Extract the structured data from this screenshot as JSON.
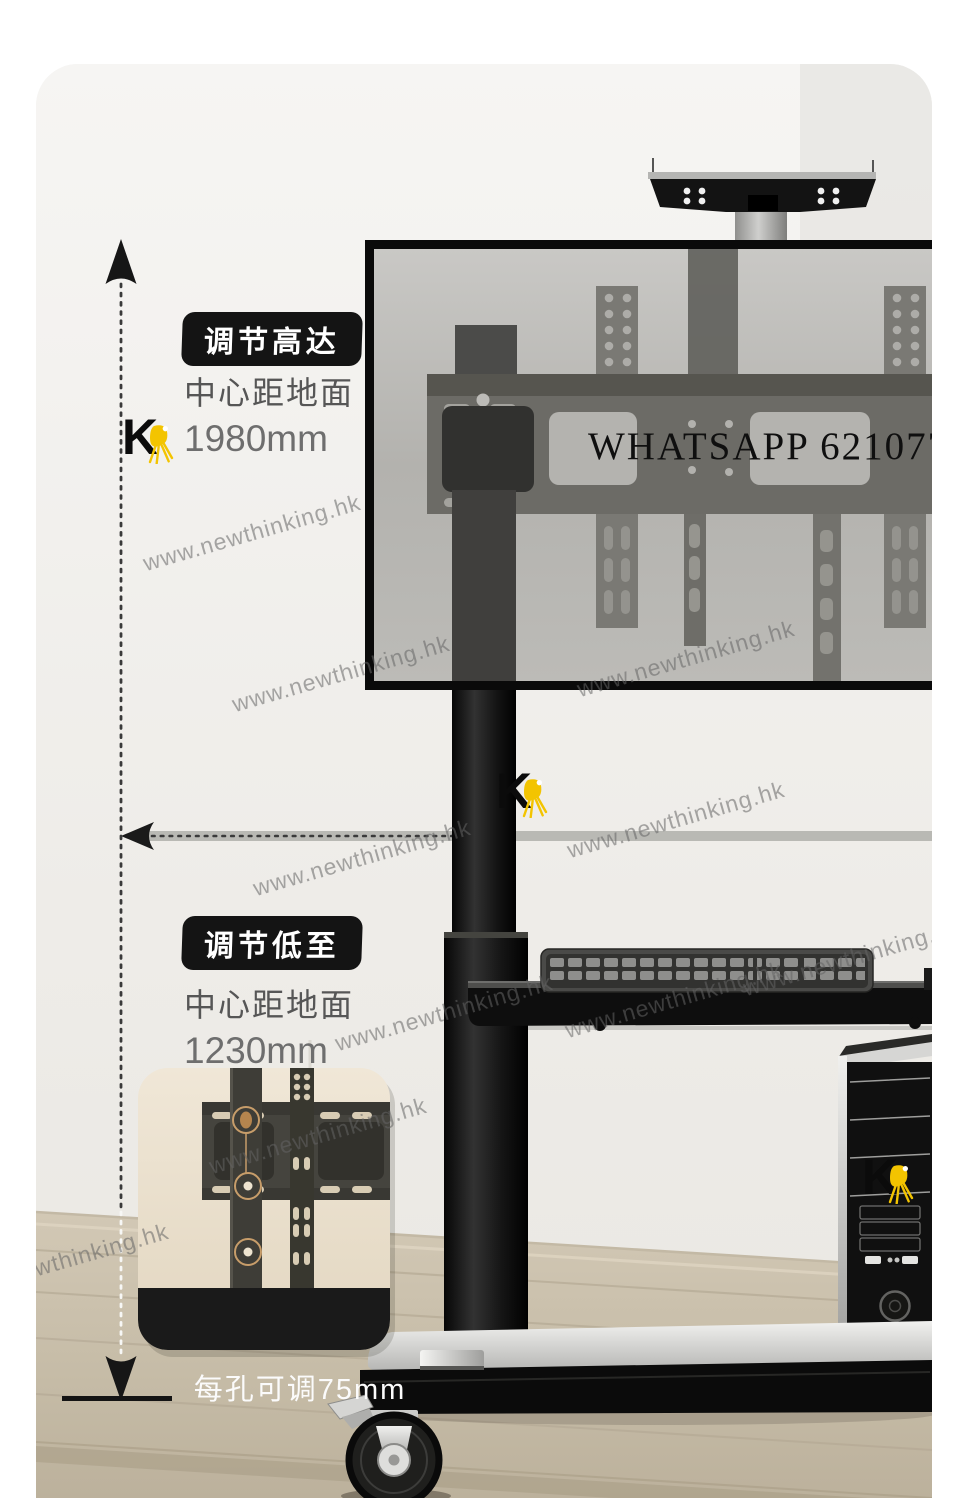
{
  "logo": {
    "letter": "K"
  },
  "overlay": {
    "whatsapp": "WHATSAPP 62107759"
  },
  "annotations": {
    "high": {
      "badge": "调节高达",
      "caption": "中心距地面",
      "value": "1980mm"
    },
    "low": {
      "badge": "调节低至",
      "caption": "中心距地面",
      "value": "1230mm"
    }
  },
  "inset": {
    "caption": "每孔可调75mm"
  },
  "watermark": {
    "text": "www.newthinking.hk",
    "items": [
      {
        "x": 252,
        "y": 533
      },
      {
        "x": 341,
        "y": 674
      },
      {
        "x": 686,
        "y": 659
      },
      {
        "x": 362,
        "y": 858
      },
      {
        "x": 676,
        "y": 820
      },
      {
        "x": 444,
        "y": 1013
      },
      {
        "x": 674,
        "y": 1000
      },
      {
        "x": 852,
        "y": 958
      },
      {
        "x": 318,
        "y": 1136
      },
      {
        "x": 60,
        "y": 1262
      }
    ]
  },
  "colors": {
    "accent_yellow": "#f3c400",
    "badge_bg": "#141414",
    "watermark_gray": "#646464",
    "wood_floor": "#c9bead",
    "panel_tint": "#b5b4b0"
  }
}
